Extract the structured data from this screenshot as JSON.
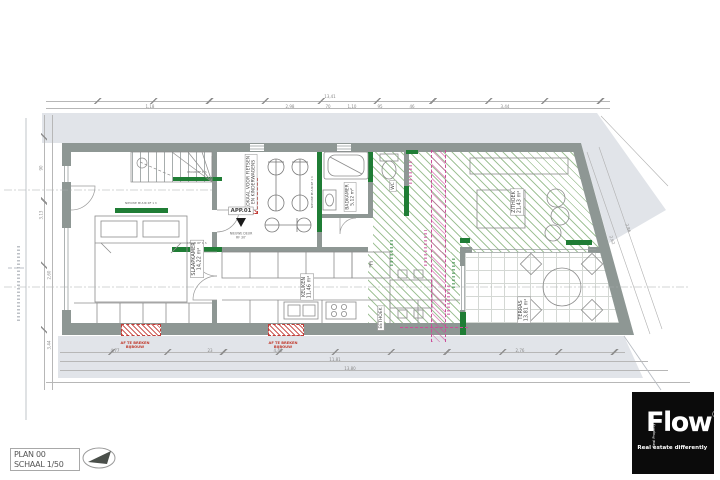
{
  "title_block": {
    "plan": "PLAN 00",
    "scale": "SCHAAL 1/50"
  },
  "logo": {
    "brand": "Flow",
    "registered": "®",
    "tagline": "Real estate differently",
    "side_text": "Real Property"
  },
  "unit": {
    "label": "APP.01",
    "door_note_line1": "NIEUWE DEUR",
    "door_note_line2": "RF 30'"
  },
  "rooms": {
    "slaapkamer": {
      "name": "SLAAPKAMER",
      "area": "14,22 m²"
    },
    "keuken": {
      "name": "KEUKEN",
      "area": "11,46 m²"
    },
    "badkamer": {
      "name": "BADKAMER",
      "area": "5,12 m²"
    },
    "wc": {
      "name": "WC"
    },
    "lokaal": {
      "line1": "LOKAAL VOOR FIETSEN",
      "line2": "EN KINDERWAGENS"
    },
    "zithoek": {
      "name": "ZITHOEK",
      "area": "21,43 m²"
    },
    "eethoek": {
      "name": "EETHOEK"
    },
    "terras": {
      "name": "TERRAS",
      "area": "13,81 m²"
    },
    "fridge": "F"
  },
  "wall_labels": {
    "nieuwe_muur_1": "NIEUWE MUUR RF 1 h",
    "muur_1": "MUUR RF 1 h",
    "muur_2": "MUUR RF 1 h",
    "nieuwe_muur_2": "NIEUWE MUUR RF 1 h"
  },
  "demolition": {
    "line1": "AF TE BREKEN",
    "line2": "BIJBOUW"
  },
  "dimensions": {
    "top_total": "13,41",
    "top": [
      "1,18",
      "2,98",
      "70",
      "1,10",
      "95",
      "46",
      "3,44"
    ],
    "bottom": [
      "4,77",
      "23",
      "4,46",
      "2,76"
    ],
    "bottom_sub": "11,81",
    "bottom_total": "13,80",
    "left": [
      "90",
      "3,13",
      "2,60",
      "3,44"
    ],
    "right": [
      "2,62",
      "2,86"
    ]
  },
  "colors": {
    "wall": "#8e9794",
    "new_wall": "#1f7d35",
    "hatch_green": "#7aaa6e",
    "demolition_red": "#c0392b",
    "annotation_magenta": "#cc4f9a",
    "neighbor_fill": "#e1e4e9",
    "logo_background": "#0b0b0b"
  }
}
